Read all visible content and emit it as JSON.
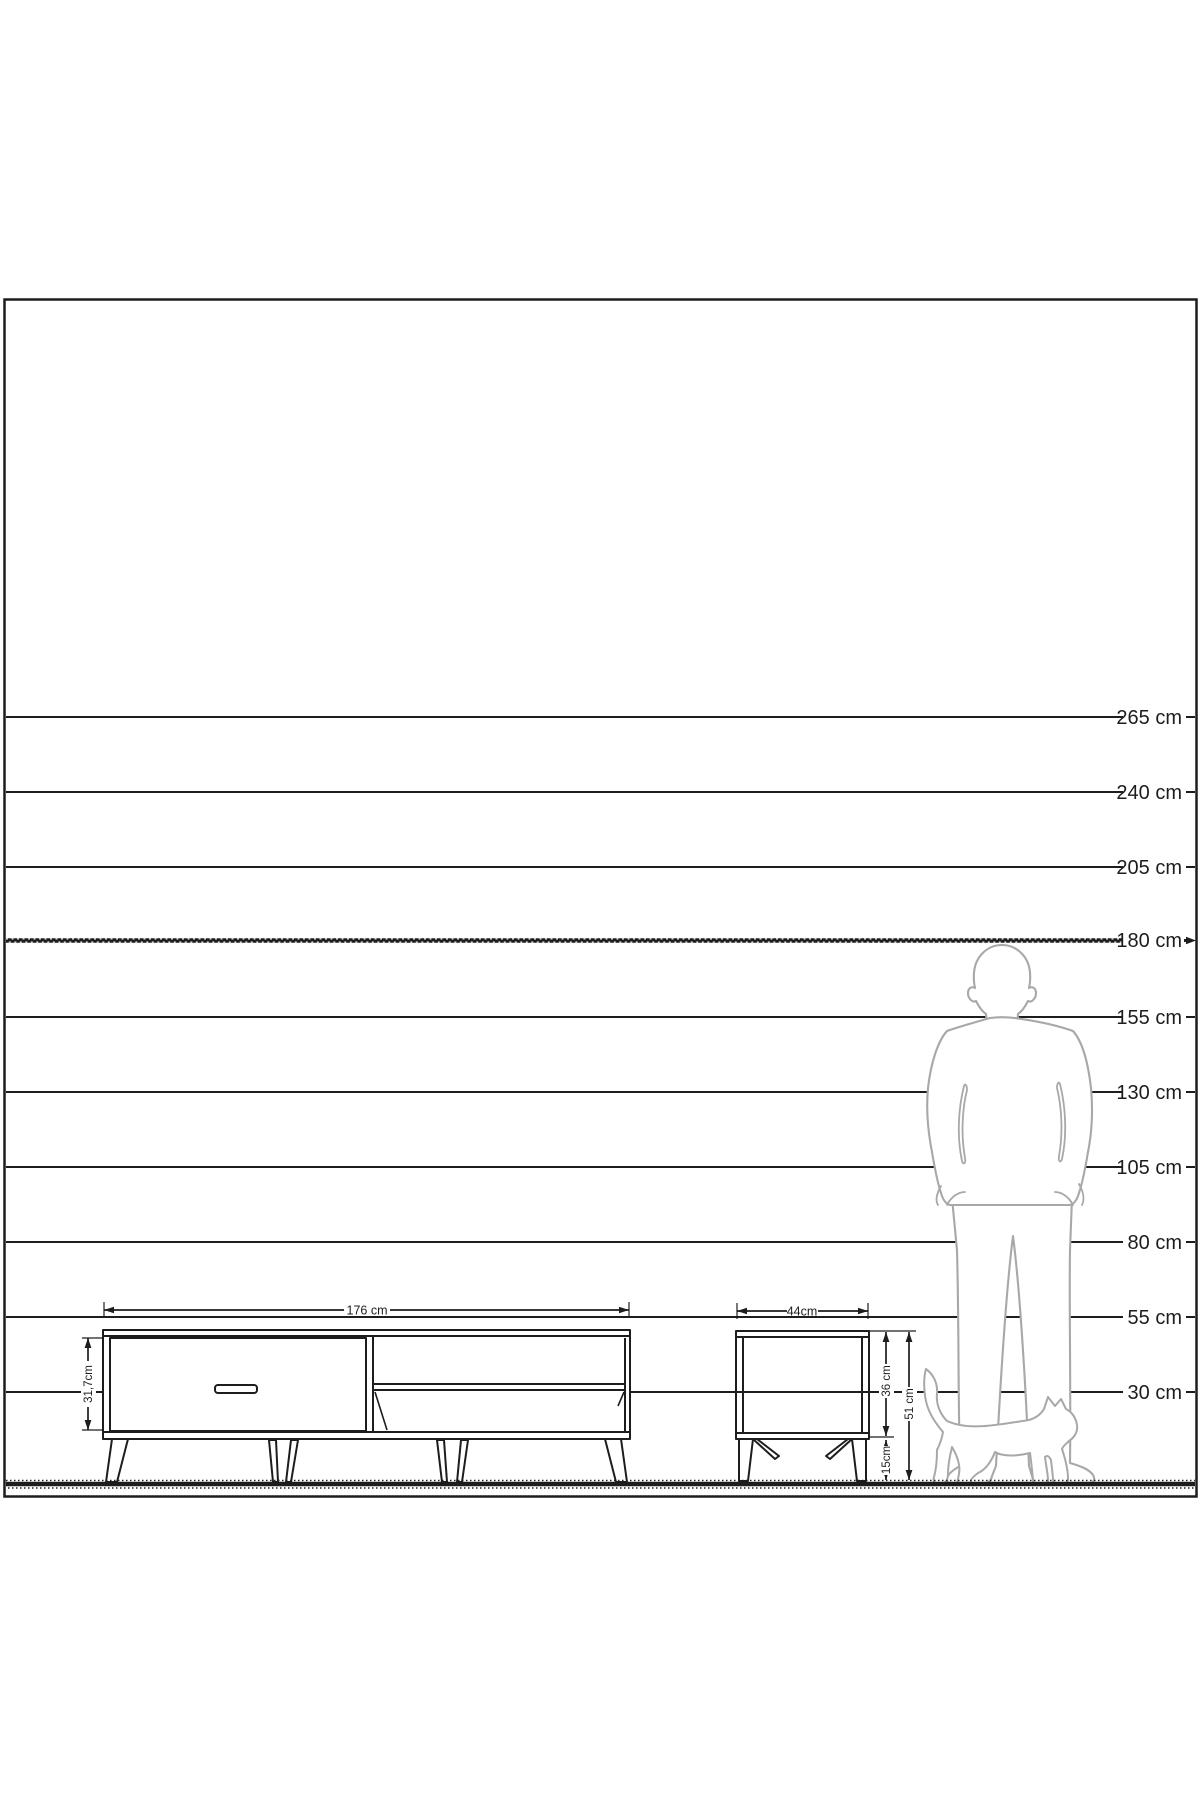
{
  "figure": {
    "type": "furniture-dimension-scale-diagram",
    "unit": "cm",
    "background_color": "#ffffff",
    "line_color": "#1d1d1b",
    "silhouette_color": "#a8a8a8",
    "emphasized_scale_line": "180 cm"
  },
  "scale_labels": [
    "265 cm",
    "240 cm",
    "205 cm",
    "180 cm",
    "155 cm",
    "130 cm",
    "105 cm",
    "80 cm",
    "55 cm",
    "30 cm"
  ],
  "tv_stand": {
    "width": "176 cm",
    "body_height": "31,7cm"
  },
  "side_table": {
    "width": "44cm",
    "body_height": "36 cm",
    "leg_height": "15cm",
    "total_height": "51 cm"
  },
  "icons": {
    "man": "standing-man-silhouette",
    "cat": "walking-cat-silhouette"
  }
}
